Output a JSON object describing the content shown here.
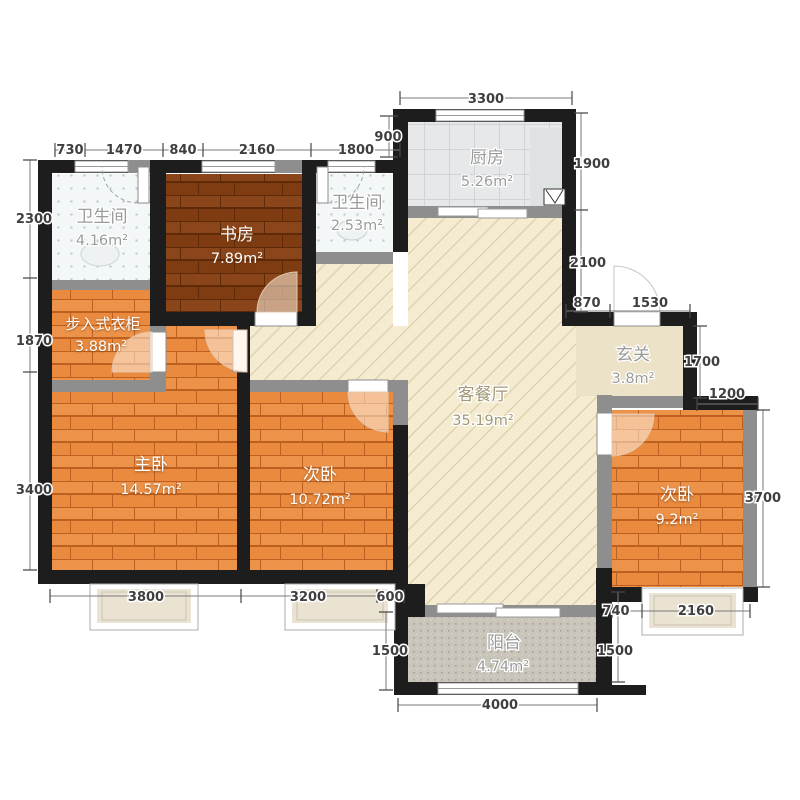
{
  "plan": {
    "title": "apartment-floor-plan",
    "rooms": {
      "bath1": {
        "name": "卫生间",
        "area": "4.16m²"
      },
      "study": {
        "name": "书房",
        "area": "7.89m²"
      },
      "bath2": {
        "name": "卫生间",
        "area": "2.53m²"
      },
      "kitchen": {
        "name": "厨房",
        "area": "5.26m²"
      },
      "living": {
        "name": "客餐厅",
        "area": "35.19m²"
      },
      "entry": {
        "name": "玄关",
        "area": "3.8m²"
      },
      "closet": {
        "name": "步入式衣柜",
        "area": "3.88m²"
      },
      "master": {
        "name": "主卧",
        "area": "14.57m²"
      },
      "bed2": {
        "name": "次卧",
        "area": "10.72m²"
      },
      "bed3": {
        "name": "次卧",
        "area": "9.2m²"
      },
      "balcony": {
        "name": "阳台",
        "area": "4.74m²"
      }
    },
    "dims": {
      "top": [
        "730",
        "1470",
        "840",
        "2160",
        "1800"
      ],
      "kitchen_width": "3300",
      "kitchen_offset": "900",
      "right": [
        "1900",
        "2100"
      ],
      "entry_top": [
        "870",
        "1530"
      ],
      "entry_right": [
        "1700",
        "1200"
      ],
      "bed3_right": "3700",
      "left": [
        "2300",
        "1870",
        "3400"
      ],
      "bottom": [
        "3800",
        "3200",
        "600"
      ],
      "balcony_left": "1500",
      "balcony_width": "4000",
      "balcony_right": "1500",
      "bed3_bottom": [
        "740",
        "2160"
      ]
    },
    "colors": {
      "wall_exterior": "#1d1d1d",
      "wall_interior": "#8e8e8e",
      "floor_wood": "#e98a3f",
      "floor_wood_dark": "#7f3c12",
      "floor_living": "#f4ebd0",
      "floor_entry": "#ece2c8",
      "floor_bath": "#f4f7f7",
      "floor_kitchen": "#e6e8e9",
      "floor_balcony": "#c9c5bb",
      "dim_text": "#3f3f3f"
    }
  }
}
